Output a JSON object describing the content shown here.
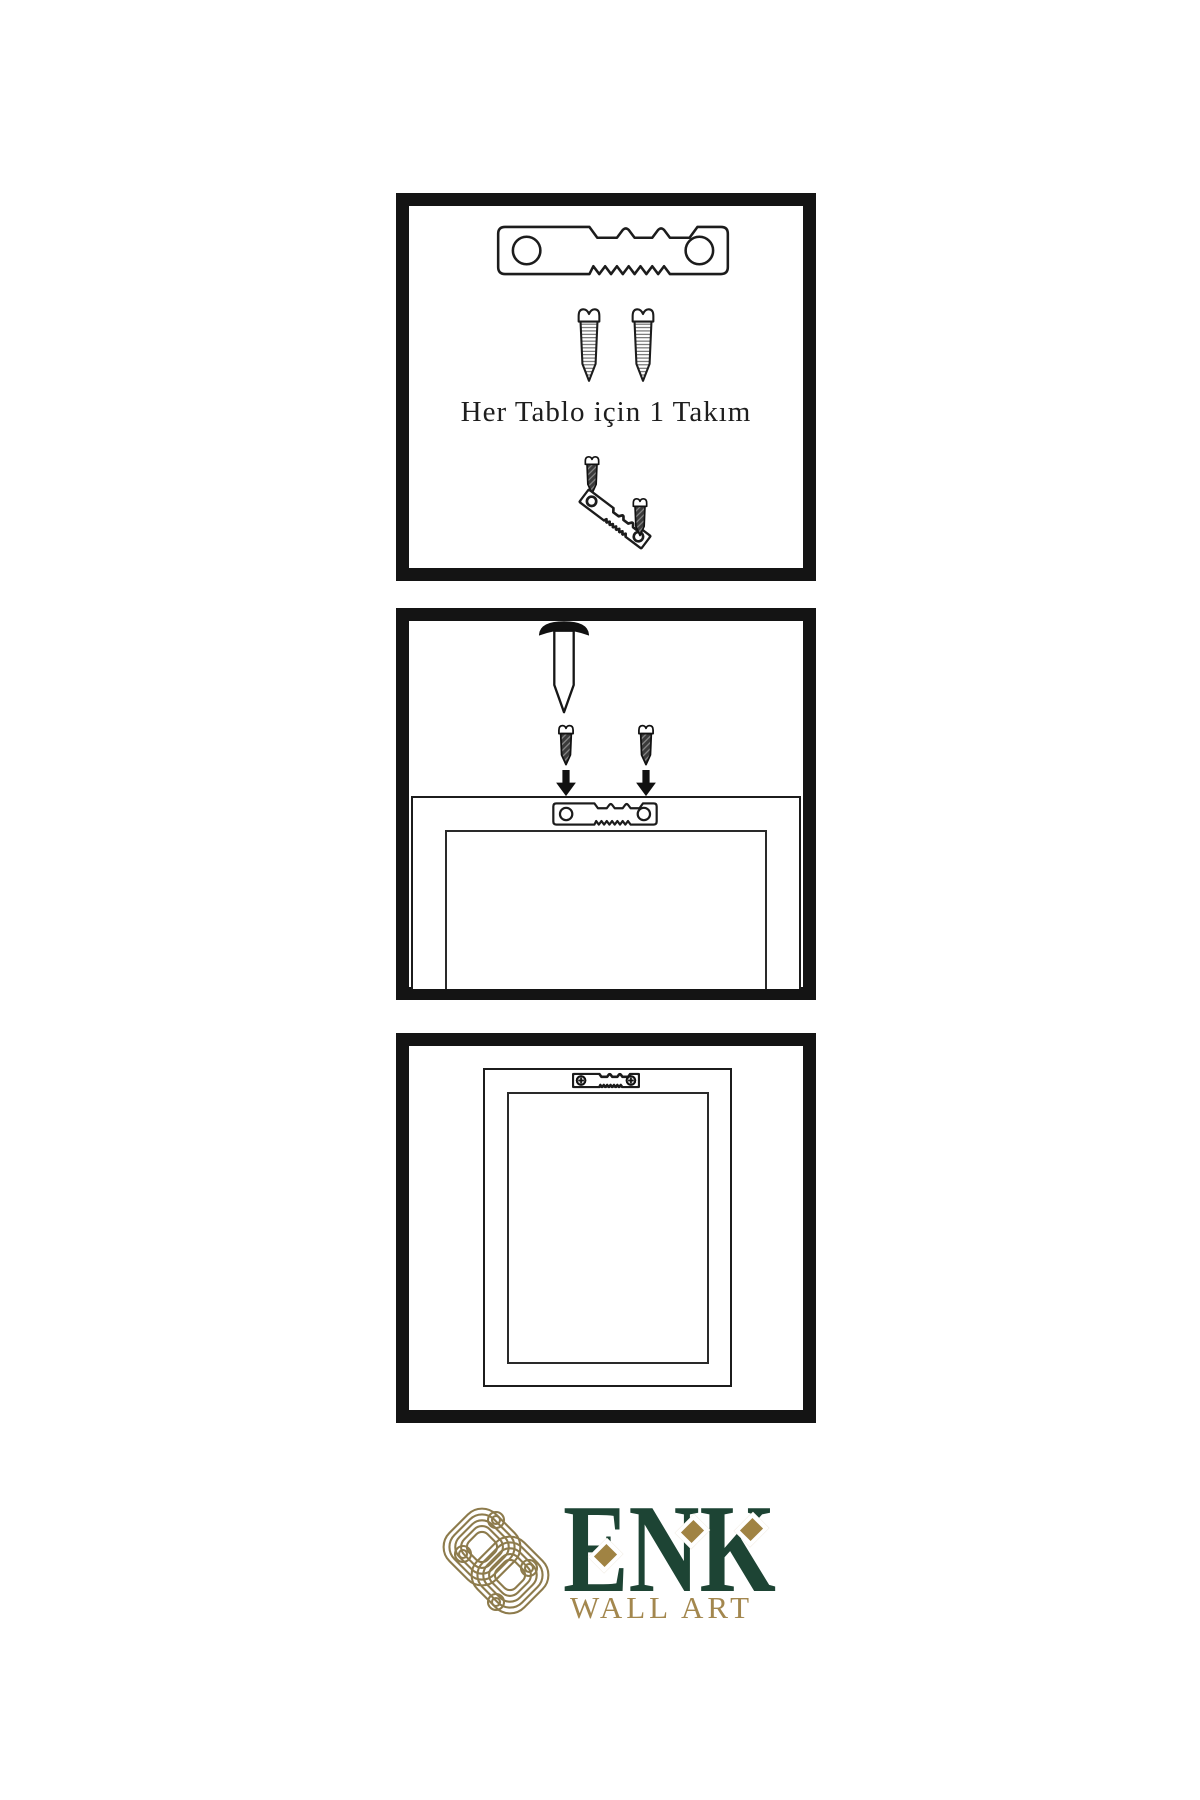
{
  "document": {
    "kind": "wall-art hanging instructions",
    "background": "#ffffff",
    "line_color": "#1c1c1c",
    "panel_border_color": "#141414"
  },
  "steps": {
    "step1": {
      "caption": "Her Tablo için 1 Takım",
      "items": [
        "sawtooth-hanger",
        "mounting-screw",
        "mounting-screw",
        "hanger-with-screws-assembly"
      ]
    },
    "step2": {
      "items": [
        "wall-nail",
        "dark-screw",
        "dark-screw",
        "down-arrow",
        "down-arrow",
        "frame-back",
        "sawtooth-hanger"
      ]
    },
    "step3": {
      "items": [
        "hung-frame",
        "mounted-sawtooth-hanger-with-phillips-screws"
      ]
    }
  },
  "logo": {
    "brand": "ENK",
    "tagline": "WALL ART",
    "brand_color": "#1d4434",
    "accent_color": "#a08343",
    "knot_color": "#8d7b4c"
  }
}
